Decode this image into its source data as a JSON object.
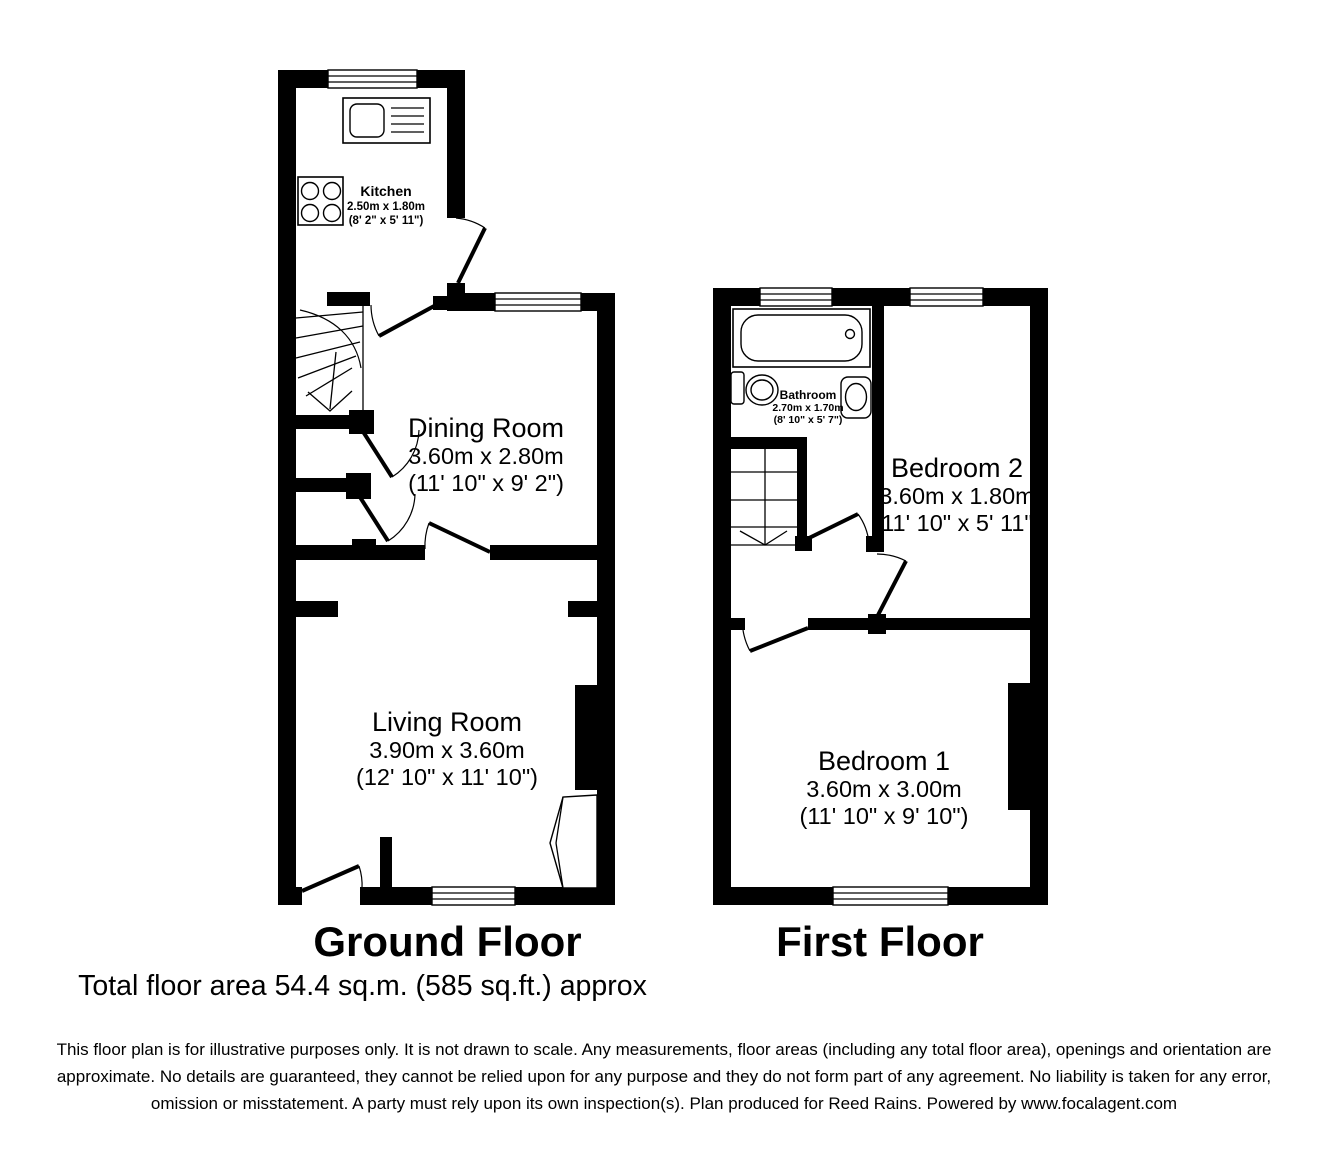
{
  "ground_floor": {
    "title": "Ground Floor",
    "kitchen": {
      "name": "Kitchen",
      "metric": "2.50m x 1.80m",
      "imperial": "(8' 2\" x 5' 11\")"
    },
    "dining": {
      "name": "Dining Room",
      "metric": "3.60m x 2.80m",
      "imperial": "(11' 10\" x 9' 2\")"
    },
    "living": {
      "name": "Living Room",
      "metric": "3.90m x 3.60m",
      "imperial": "(12' 10\" x 11' 10\")"
    }
  },
  "first_floor": {
    "title": "First Floor",
    "bathroom": {
      "name": "Bathroom",
      "metric": "2.70m x 1.70m",
      "imperial": "(8' 10\" x 5' 7\")"
    },
    "bedroom2": {
      "name": "Bedroom 2",
      "metric": "3.60m x 1.80m",
      "imperial": "(11' 10\" x 5' 11\")"
    },
    "bedroom1": {
      "name": "Bedroom 1",
      "metric": "3.60m x 3.00m",
      "imperial": "(11' 10\" x 9' 10\")"
    }
  },
  "total_area": "Total floor area 54.4 sq.m. (585 sq.ft.) approx",
  "disclaimer": "This floor plan is for illustrative purposes only. It is not drawn to scale. Any measurements, floor areas (including any total floor area), openings and orientation are approximate. No details are guaranteed, they cannot be relied upon for any purpose and they do not form part of any agreement. No liability is taken for any error, omission or misstatement. A party must rely upon its own inspection(s). Plan produced for Reed Rains. Powered by www.focalagent.com",
  "colors": {
    "wall": "#000000",
    "background": "#ffffff"
  }
}
